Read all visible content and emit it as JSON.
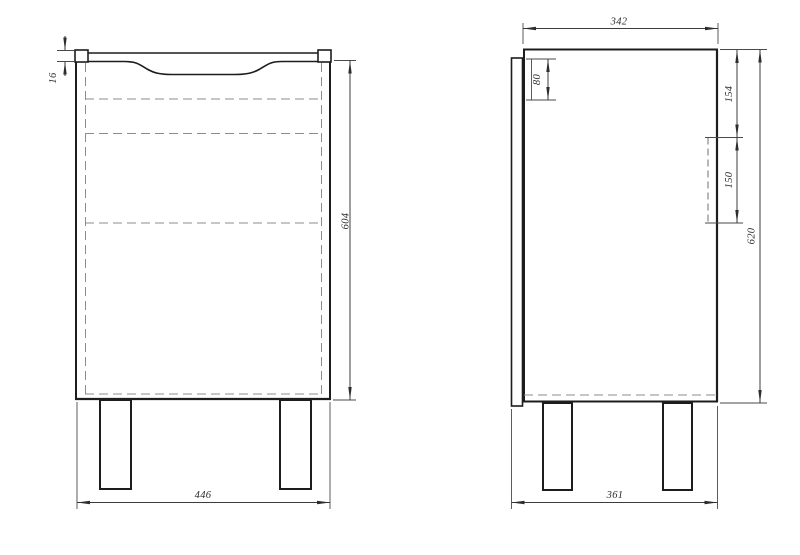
{
  "drawing": {
    "type": "furniture-technical-drawing",
    "units": "mm",
    "colors": {
      "background": "#ffffff",
      "outline": "#1d1d1d",
      "dimension": "#3c3c3c",
      "hidden_line": "#8c8c8c"
    },
    "front_view": {
      "dim_top_thickness": "16",
      "dim_height": "604",
      "dim_width": "446"
    },
    "side_view": {
      "dim_body_depth": "342",
      "dim_top_offset": "80",
      "dim_bracket_top_offset": "154",
      "dim_bracket_height": "150",
      "dim_height": "620",
      "dim_total_depth": "361"
    }
  }
}
